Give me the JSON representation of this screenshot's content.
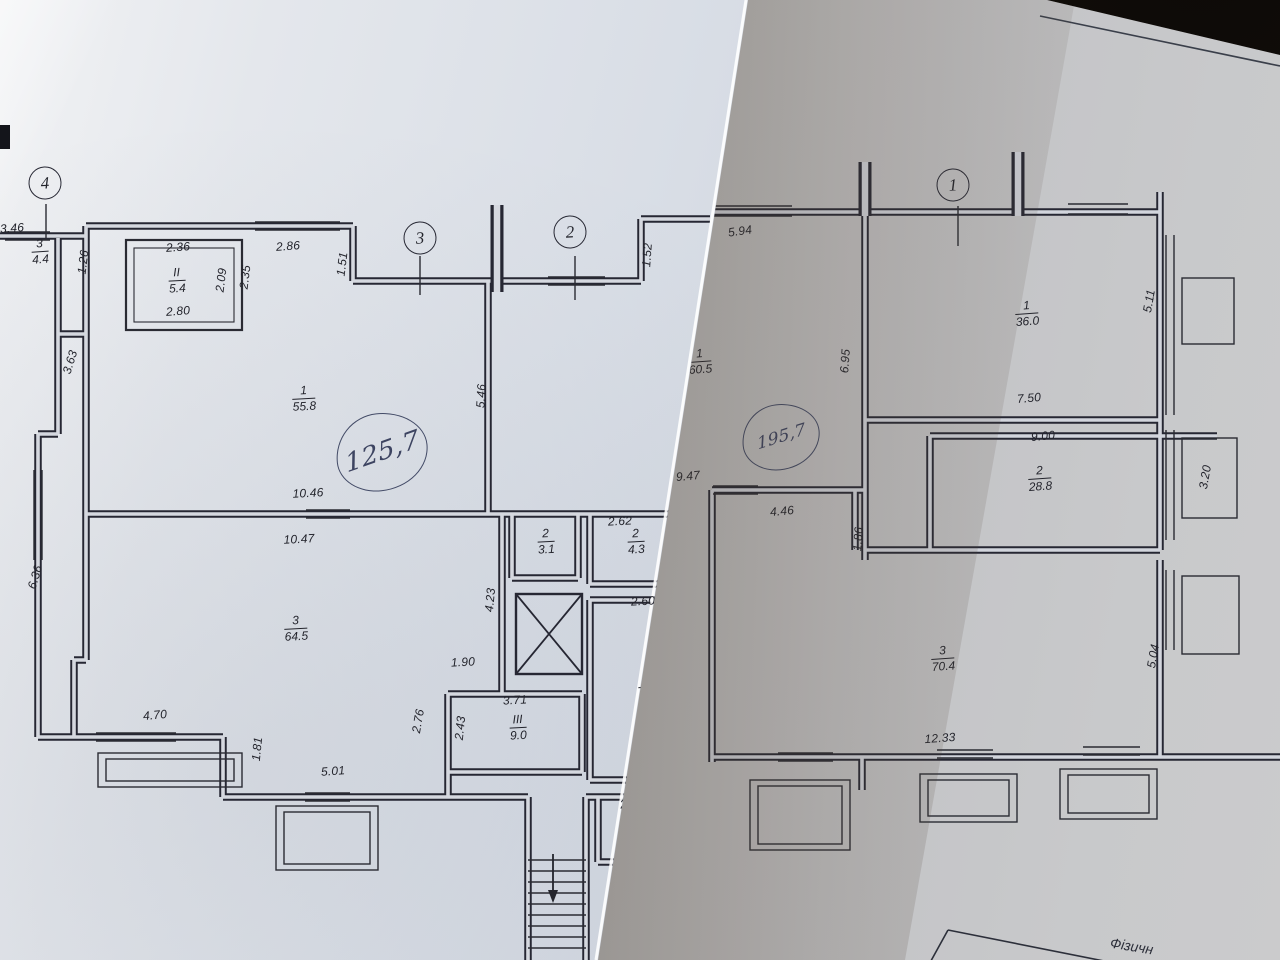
{
  "scene": {
    "background_color": "#17110c",
    "paper_left_color": "#dde2ea",
    "paper_right_color": "#c9c9cd",
    "ink_color": "#262733",
    "pen_color": "#3d4461"
  },
  "left_sheet": {
    "axis_markers": [
      {
        "label": "4",
        "x": 45,
        "y": 183
      },
      {
        "label": "3",
        "x": 420,
        "y": 238
      },
      {
        "label": "2",
        "x": 570,
        "y": 232
      }
    ],
    "room_labels": [
      {
        "num": "3",
        "den": "4.4",
        "x": 40,
        "y": 252,
        "rot": -4
      },
      {
        "num": "II",
        "den": "5.4",
        "x": 177,
        "y": 281,
        "rot": -3
      },
      {
        "num": "1",
        "den": "55.8",
        "x": 304,
        "y": 399,
        "rot": -3
      },
      {
        "num": "2",
        "den": "3.1",
        "x": 546,
        "y": 542,
        "rot": -3
      },
      {
        "num": "2",
        "den": "4.3",
        "x": 636,
        "y": 542,
        "rot": -3
      },
      {
        "num": "3",
        "den": "64.5",
        "x": 296,
        "y": 629,
        "rot": -3
      },
      {
        "num": "III",
        "den": "9.0",
        "x": 518,
        "y": 728,
        "rot": -3
      },
      {
        "num": "V",
        "den": "12.9",
        "x": 650,
        "y": 687,
        "rot": -5
      },
      {
        "num": "IV",
        "den": "4.4",
        "x": 648,
        "y": 821,
        "rot": -8
      }
    ],
    "dimensions": [
      {
        "text": "3.46",
        "x": 12,
        "y": 228,
        "rot": -4
      },
      {
        "text": "2.36",
        "x": 178,
        "y": 247,
        "rot": -4
      },
      {
        "text": "2.86",
        "x": 288,
        "y": 246,
        "rot": -4
      },
      {
        "text": "1.51",
        "x": 342,
        "y": 264,
        "rot": -83
      },
      {
        "text": "2.80",
        "x": 178,
        "y": 311,
        "rot": -4
      },
      {
        "text": "2.09",
        "x": 221,
        "y": 280,
        "rot": -83
      },
      {
        "text": "2.35",
        "x": 245,
        "y": 277,
        "rot": -83
      },
      {
        "text": "1.26",
        "x": 83,
        "y": 262,
        "rot": -83
      },
      {
        "text": "1.52",
        "x": 647,
        "y": 255,
        "rot": -86
      },
      {
        "text": "3.63",
        "x": 70,
        "y": 362,
        "rot": -73
      },
      {
        "text": "5.46",
        "x": 481,
        "y": 396,
        "rot": -87
      },
      {
        "text": "10.46",
        "x": 308,
        "y": 493,
        "rot": -3
      },
      {
        "text": "10.47",
        "x": 299,
        "y": 539,
        "rot": -3
      },
      {
        "text": "2.62",
        "x": 620,
        "y": 521,
        "rot": -3
      },
      {
        "text": "1.65",
        "x": 680,
        "y": 539,
        "rot": -85
      },
      {
        "text": "2.60",
        "x": 643,
        "y": 601,
        "rot": -3
      },
      {
        "text": "4.23",
        "x": 490,
        "y": 600,
        "rot": -85
      },
      {
        "text": "6.36",
        "x": 35,
        "y": 577,
        "rot": -73
      },
      {
        "text": "1.90",
        "x": 463,
        "y": 662,
        "rot": -3
      },
      {
        "text": "2.76",
        "x": 418,
        "y": 721,
        "rot": -80
      },
      {
        "text": "3.71",
        "x": 515,
        "y": 700,
        "rot": -3
      },
      {
        "text": "2.43",
        "x": 460,
        "y": 728,
        "rot": -84
      },
      {
        "text": "4.97",
        "x": 683,
        "y": 685,
        "rot": -86
      },
      {
        "text": "4.70",
        "x": 155,
        "y": 715,
        "rot": -5
      },
      {
        "text": "1.81",
        "x": 257,
        "y": 749,
        "rot": -84
      },
      {
        "text": "5.01",
        "x": 333,
        "y": 771,
        "rot": -4
      },
      {
        "text": "2.79",
        "x": 632,
        "y": 803,
        "rot": -8
      },
      {
        "text": "1.56",
        "x": 690,
        "y": 816,
        "rot": -80
      }
    ],
    "handwriting": {
      "text": "125,7",
      "x": 381,
      "y": 451,
      "rx": 45,
      "ry": 38,
      "rot": -14,
      "size": 26
    }
  },
  "right_sheet": {
    "axis_markers": [
      {
        "label": "1",
        "x": 953,
        "y": 185
      }
    ],
    "room_labels": [
      {
        "num": "1",
        "den": "60.5",
        "x": 700,
        "y": 362,
        "rot": -4
      },
      {
        "num": "1",
        "den": "36.0",
        "x": 1027,
        "y": 314,
        "rot": -4
      },
      {
        "num": "2",
        "den": "28.8",
        "x": 1040,
        "y": 479,
        "rot": -4
      },
      {
        "num": "3",
        "den": "70.4",
        "x": 943,
        "y": 659,
        "rot": -4
      }
    ],
    "dimensions": [
      {
        "text": "5.94",
        "x": 740,
        "y": 231,
        "rot": -8
      },
      {
        "text": "6.95",
        "x": 845,
        "y": 361,
        "rot": -86
      },
      {
        "text": "5.11",
        "x": 1149,
        "y": 301,
        "rot": -80
      },
      {
        "text": "7.50",
        "x": 1029,
        "y": 398,
        "rot": -5
      },
      {
        "text": "9.00",
        "x": 1043,
        "y": 436,
        "rot": -5
      },
      {
        "text": "3.20",
        "x": 1205,
        "y": 477,
        "rot": -80
      },
      {
        "text": "9.47",
        "x": 688,
        "y": 476,
        "rot": -5
      },
      {
        "text": "4.46",
        "x": 782,
        "y": 511,
        "rot": -5
      },
      {
        "text": "1.86",
        "x": 858,
        "y": 539,
        "rot": -86
      },
      {
        "text": "5.04",
        "x": 1153,
        "y": 656,
        "rot": -80
      },
      {
        "text": "12.33",
        "x": 940,
        "y": 738,
        "rot": -4
      }
    ],
    "handwriting": {
      "text": "195,7",
      "x": 780,
      "y": 436,
      "rx": 38,
      "ry": 32,
      "rot": -12,
      "size": 17
    },
    "table_caption": {
      "text": "Фізичн"
    }
  }
}
